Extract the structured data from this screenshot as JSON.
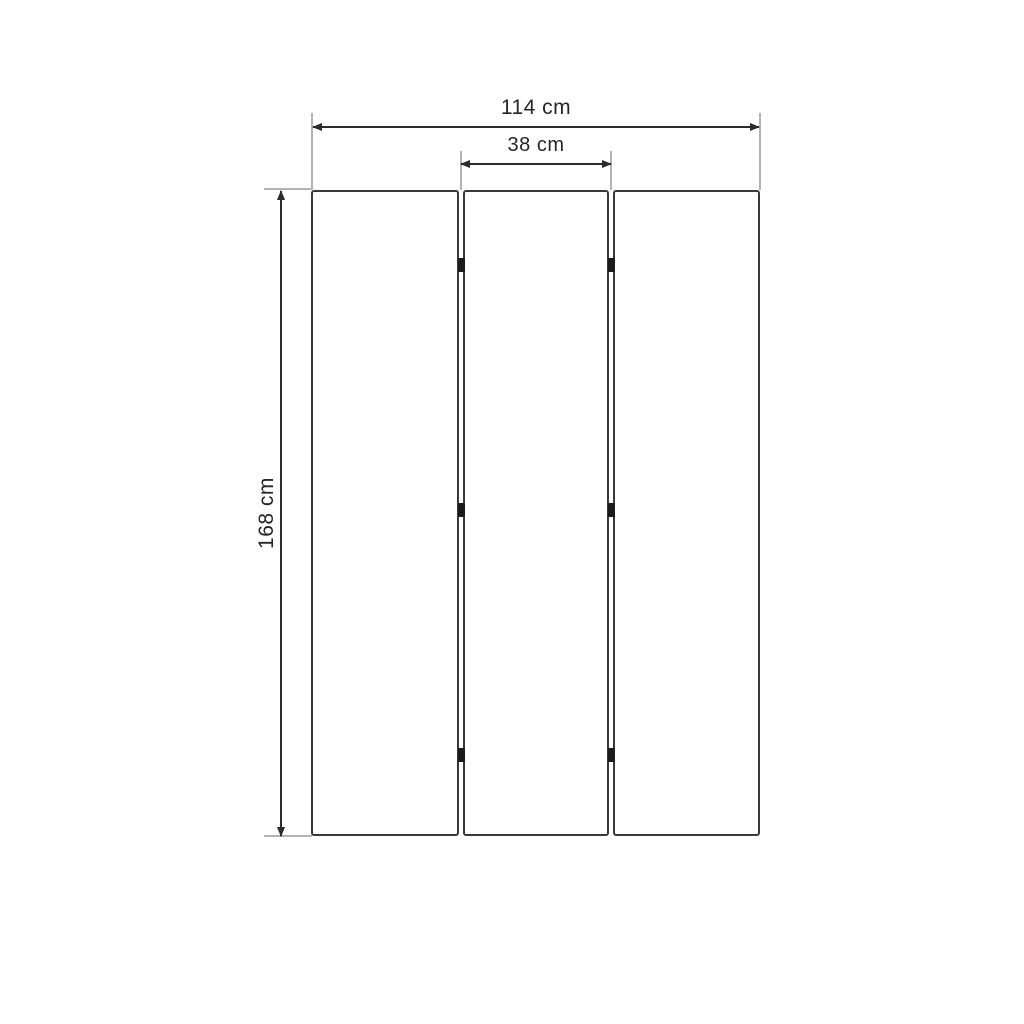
{
  "diagram": {
    "type": "dimensioned-drawing",
    "panel_count": 3,
    "hinge_count": 6,
    "dimensions": {
      "overall_width": "114 cm",
      "panel_width": "38 cm",
      "height": "168 cm"
    },
    "colors": {
      "background": "#ffffff",
      "panel_border": "#3a3a3a",
      "dimension_line": "#2b2b2b",
      "extension_line": "#b3b3b3",
      "hinge": "#1b1b1b",
      "text": "#262626"
    }
  }
}
